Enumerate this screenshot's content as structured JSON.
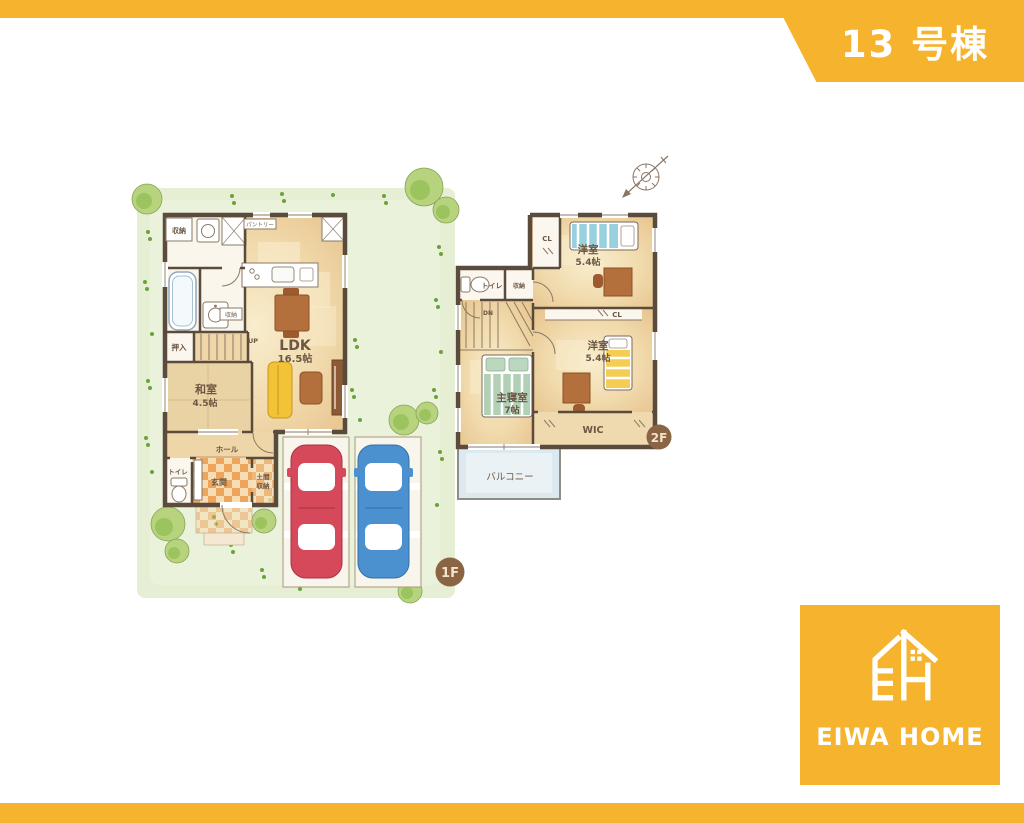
{
  "page": {
    "unit_badge": "13 号棟",
    "floor1_badge": "1F",
    "floor2_badge": "2F"
  },
  "brand": {
    "logo_text": "EIWA HOME"
  },
  "floor1": {
    "ldk_name": "LDK",
    "ldk_size": "16.5帖",
    "washitsu_name": "和室",
    "washitsu_size": "4.5帖",
    "pantry": "パントリー",
    "storage_top": "収納",
    "storage_wash": "収納",
    "oshiire": "押入",
    "up": "UP",
    "hall": "ホール",
    "toilet": "トイレ",
    "genkan": "玄関",
    "doma_line1": "土間",
    "doma_line2": "収納"
  },
  "floor2": {
    "bedroom_a_name": "洋室",
    "bedroom_a_size": "5.4帖",
    "bedroom_b_name": "洋室",
    "bedroom_b_size": "5.4帖",
    "master_name": "主寝室",
    "master_size": "7帖",
    "wic": "WIC",
    "balcony": "バルコニー",
    "cl_a": "CL",
    "cl_b": "CL",
    "toilet": "トイレ",
    "storage": "収納",
    "dn": "DN"
  },
  "colors": {
    "brand_orange": "#F5B32E",
    "wall": "#5B4B3C",
    "label_brown": "#6B5743",
    "badge_brown": "#8A6443",
    "car_red": "#D5495A",
    "car_blue": "#4B90CF",
    "balcony_blue": "#DCE9F1",
    "garden_green": "#E6EFD4",
    "genkan_orange": "#EDA45C",
    "genkan_cream": "#F8DCB2"
  }
}
